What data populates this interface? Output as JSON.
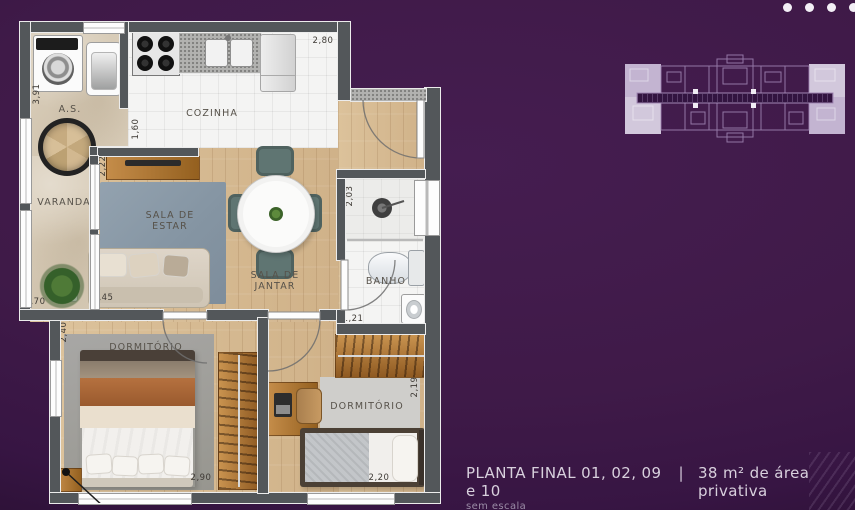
{
  "colors": {
    "background": "#3f1a48",
    "wall": "#53575a",
    "highlight_unit": "#cdc1d8"
  },
  "decor": {
    "dots_count": 4
  },
  "plan": {
    "labels": {
      "service": "A.S.",
      "kitchen": "COZINHA",
      "balcony": "VARANDA",
      "living": "SALA DE\nESTAR",
      "dining": "SALA DE\nJANTAR",
      "bath": "BANHO",
      "bedroom1": "DORMITÓRIO",
      "bedroom2": "DORMITÓRIO"
    },
    "dimensions": {
      "service_v": "3,91",
      "kitchen_w": "2,80",
      "kitchen_v": "1,60",
      "living_v": "2,22",
      "living_w": "3,45",
      "balcony_w": ",70",
      "bath_v": "2,03",
      "bath_w": "1,21",
      "bedroom1_v": "2,40",
      "bedroom1_w": "2,90",
      "bedroom2_v": "2,19",
      "bedroom2_w": "2,20"
    }
  },
  "caption": {
    "title": "PLANTA FINAL 01, 02, 09 e 10",
    "separator": "|",
    "area": "38 m² de área privativa",
    "scale_note": "sem escala"
  }
}
